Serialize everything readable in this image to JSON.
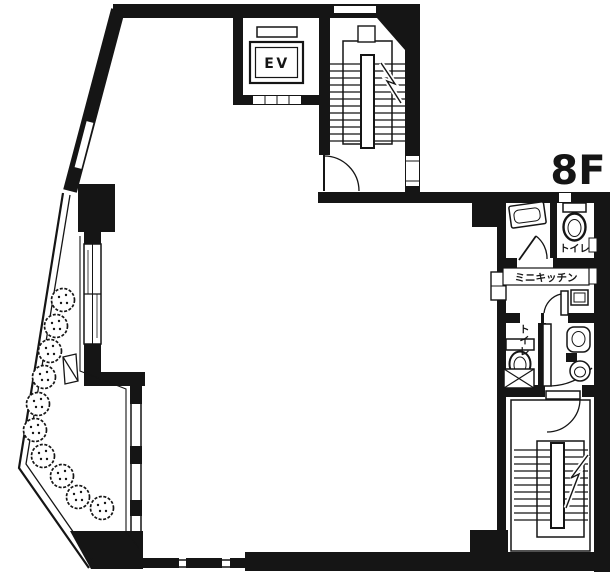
{
  "title": "Floor plan",
  "floor_label": "8F",
  "elevator_label": "EV",
  "labels": {
    "toilet_upper": "トイレ",
    "mini_kitchen": "ミニキッチン",
    "toilet_lower": "トイレ"
  },
  "colors": {
    "ink": "#151515",
    "paper": "#ffffff"
  },
  "plants": {
    "count": 10,
    "radius": 11.5,
    "positions": [
      [
        63,
        300
      ],
      [
        56,
        326
      ],
      [
        50,
        351
      ],
      [
        44,
        377
      ],
      [
        38,
        404
      ],
      [
        35,
        430
      ],
      [
        43,
        456
      ],
      [
        62,
        476
      ],
      [
        78,
        497
      ],
      [
        102,
        508
      ]
    ]
  }
}
